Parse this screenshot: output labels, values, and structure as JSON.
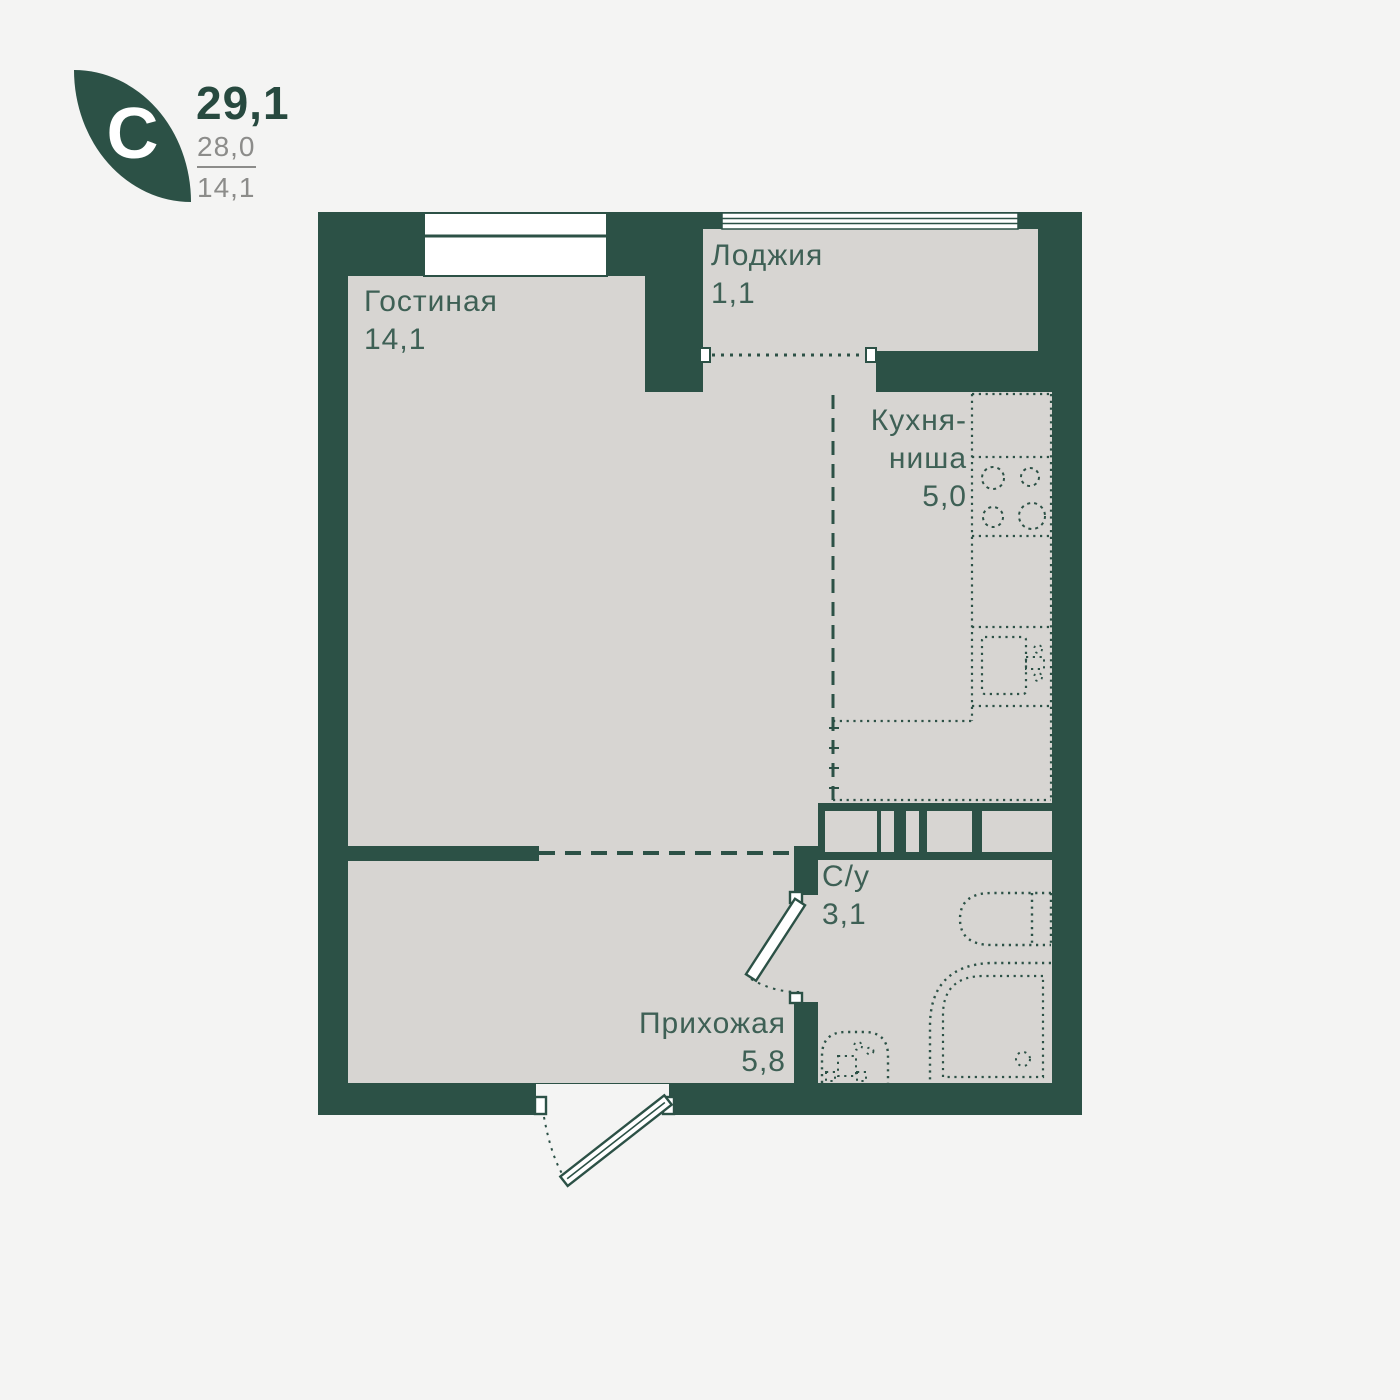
{
  "logo": {
    "type_letter": "С",
    "area_total": "29,1",
    "area_secondary": "28,0",
    "area_living": "14,1"
  },
  "rooms": {
    "living": {
      "name": "Гостиная",
      "area": "14,1"
    },
    "loggia": {
      "name": "Лоджия",
      "area": "1,1"
    },
    "kitchen": {
      "name_line1": "Кухня-",
      "name_line2": "ниша",
      "area": "5,0"
    },
    "bathroom": {
      "name": "С/у",
      "area": "3,1"
    },
    "hallway": {
      "name": "Прихожая",
      "area": "5,8"
    }
  },
  "colors": {
    "wall": "#2c5146",
    "floor": "#d7d5d2",
    "background": "#f4f4f3",
    "label": "#3e6055",
    "accent_text": "#27493f",
    "muted_text": "#8c8c8a",
    "window": "#ffffff"
  }
}
